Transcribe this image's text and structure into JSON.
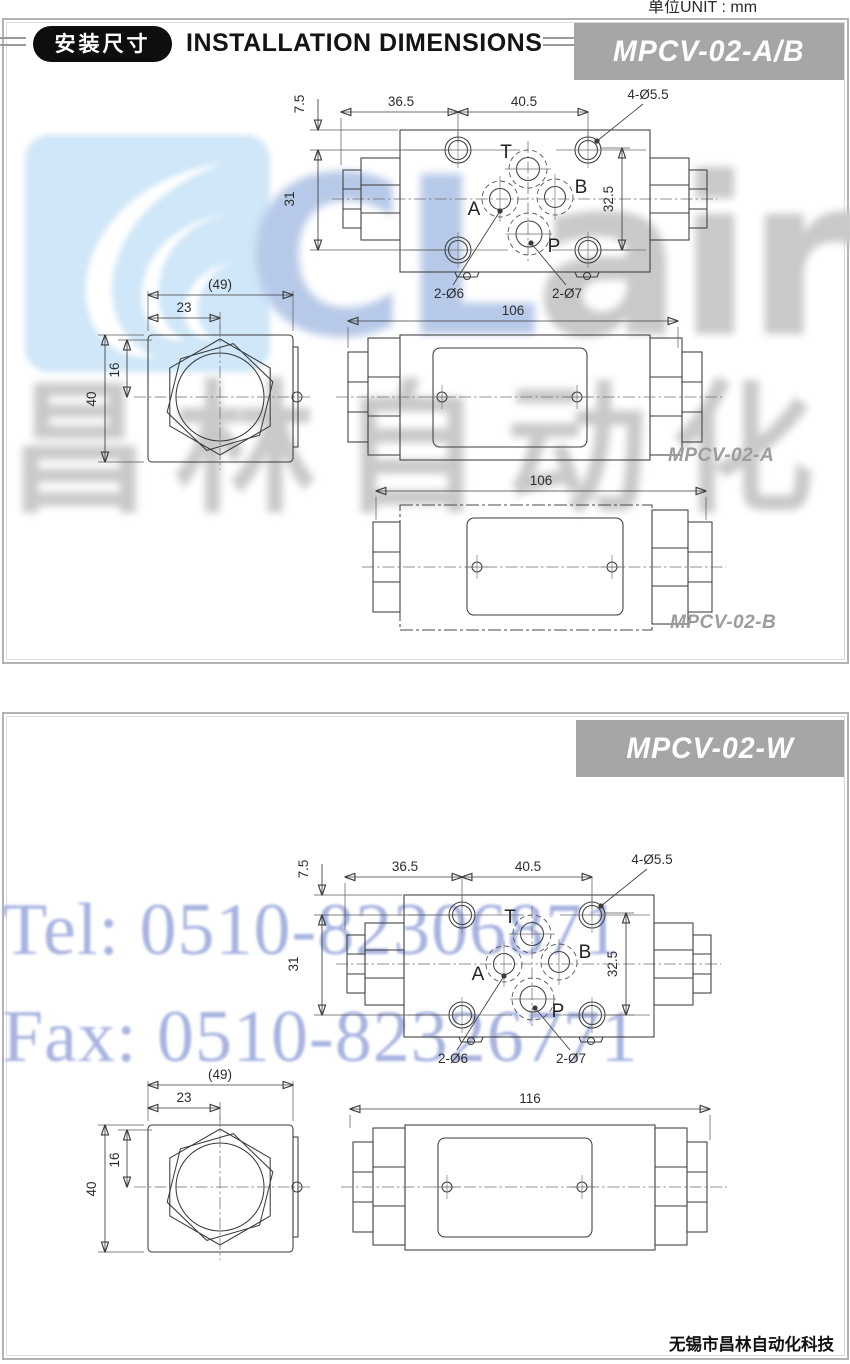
{
  "header": {
    "badge": "安装尺寸",
    "title": "INSTALLATION DIMENSIONS",
    "unit": "单位UNIT : mm"
  },
  "watermarks": {
    "logo_blue_letters": "CL",
    "logo_gray_letters": "air",
    "chinese": "昌林自动化",
    "tel": "Tel: 0510-82306871",
    "fax": "Fax: 0510-82326771"
  },
  "footer": {
    "company": "无锡市昌林自动化科技"
  },
  "panel1": {
    "banner": "MPCV-02-A/B",
    "top_view": {
      "dim_offset": "7.5",
      "dim_left": "36.5",
      "dim_right": "40.5",
      "dim_holes": "4-Ø5.5",
      "dim_vleft": "31",
      "dim_vright": "32.5",
      "dim_port_small": "2-Ø6",
      "dim_port_large": "2-Ø7",
      "port_t": "T",
      "port_a": "A",
      "port_b": "B",
      "port_p": "P"
    },
    "hex_view": {
      "dim_total": "(49)",
      "dim_center": "23",
      "dim_16": "16",
      "dim_40": "40"
    },
    "view_a": {
      "dim_length": "106",
      "label": "MPCV-02-A"
    },
    "view_b": {
      "dim_length": "106",
      "label": "MPCV-02-B"
    }
  },
  "panel2": {
    "banner": "MPCV-02-W",
    "top_view": {
      "dim_offset": "7.5",
      "dim_left": "36.5",
      "dim_right": "40.5",
      "dim_holes": "4-Ø5.5",
      "dim_vleft": "31",
      "dim_vright": "32.5",
      "dim_port_small": "2-Ø6",
      "dim_port_large": "2-Ø7",
      "port_t": "T",
      "port_a": "A",
      "port_b": "B",
      "port_p": "P"
    },
    "hex_view": {
      "dim_total": "(49)",
      "dim_center": "23",
      "dim_16": "16",
      "dim_40": "40"
    },
    "view_w": {
      "dim_length": "116"
    }
  },
  "colors": {
    "banner-bg": "#a6a6a6",
    "banner-text": "#ffffff",
    "line": "#3c3c3c",
    "badge-bg": "#0e0e0e",
    "wm-tile": "#cfe7f8",
    "wm-blue": "#b7c9e8",
    "wm-gray": "#c9c9c9",
    "wm-telfax": "#a8b4e0",
    "label-gray": "#9c9c9c"
  }
}
